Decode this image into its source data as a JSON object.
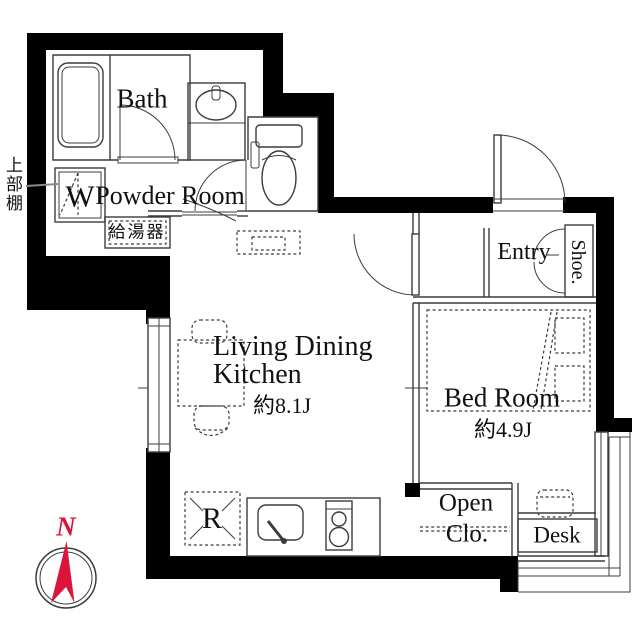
{
  "plan": {
    "type": "apartment-floor-plan",
    "rooms": {
      "bath": {
        "label": "Bath"
      },
      "powder_room": {
        "label": "Powder Room"
      },
      "living_dining_kitchen": {
        "label_line1": "Living Dining",
        "label_line2": "Kitchen",
        "area": "約8.1J"
      },
      "bed_room": {
        "label": "Bed Room",
        "area": "約4.9J"
      },
      "entry": {
        "label": "Entry"
      },
      "shoe_cabinet": {
        "label": "Shoe."
      },
      "open_closet": {
        "label_line1": "Open",
        "label_line2": "Clo."
      },
      "desk": {
        "label": "Desk"
      }
    },
    "fixtures": {
      "washing_machine": "W",
      "refrigerator": "R",
      "upper_shelf": "上部棚",
      "water_heater": "給湯器"
    },
    "compass": {
      "north": "N"
    },
    "colors": {
      "wall": "#000000",
      "line": "#3c3c3c",
      "accent": "#dc143c",
      "background": "#ffffff"
    }
  }
}
